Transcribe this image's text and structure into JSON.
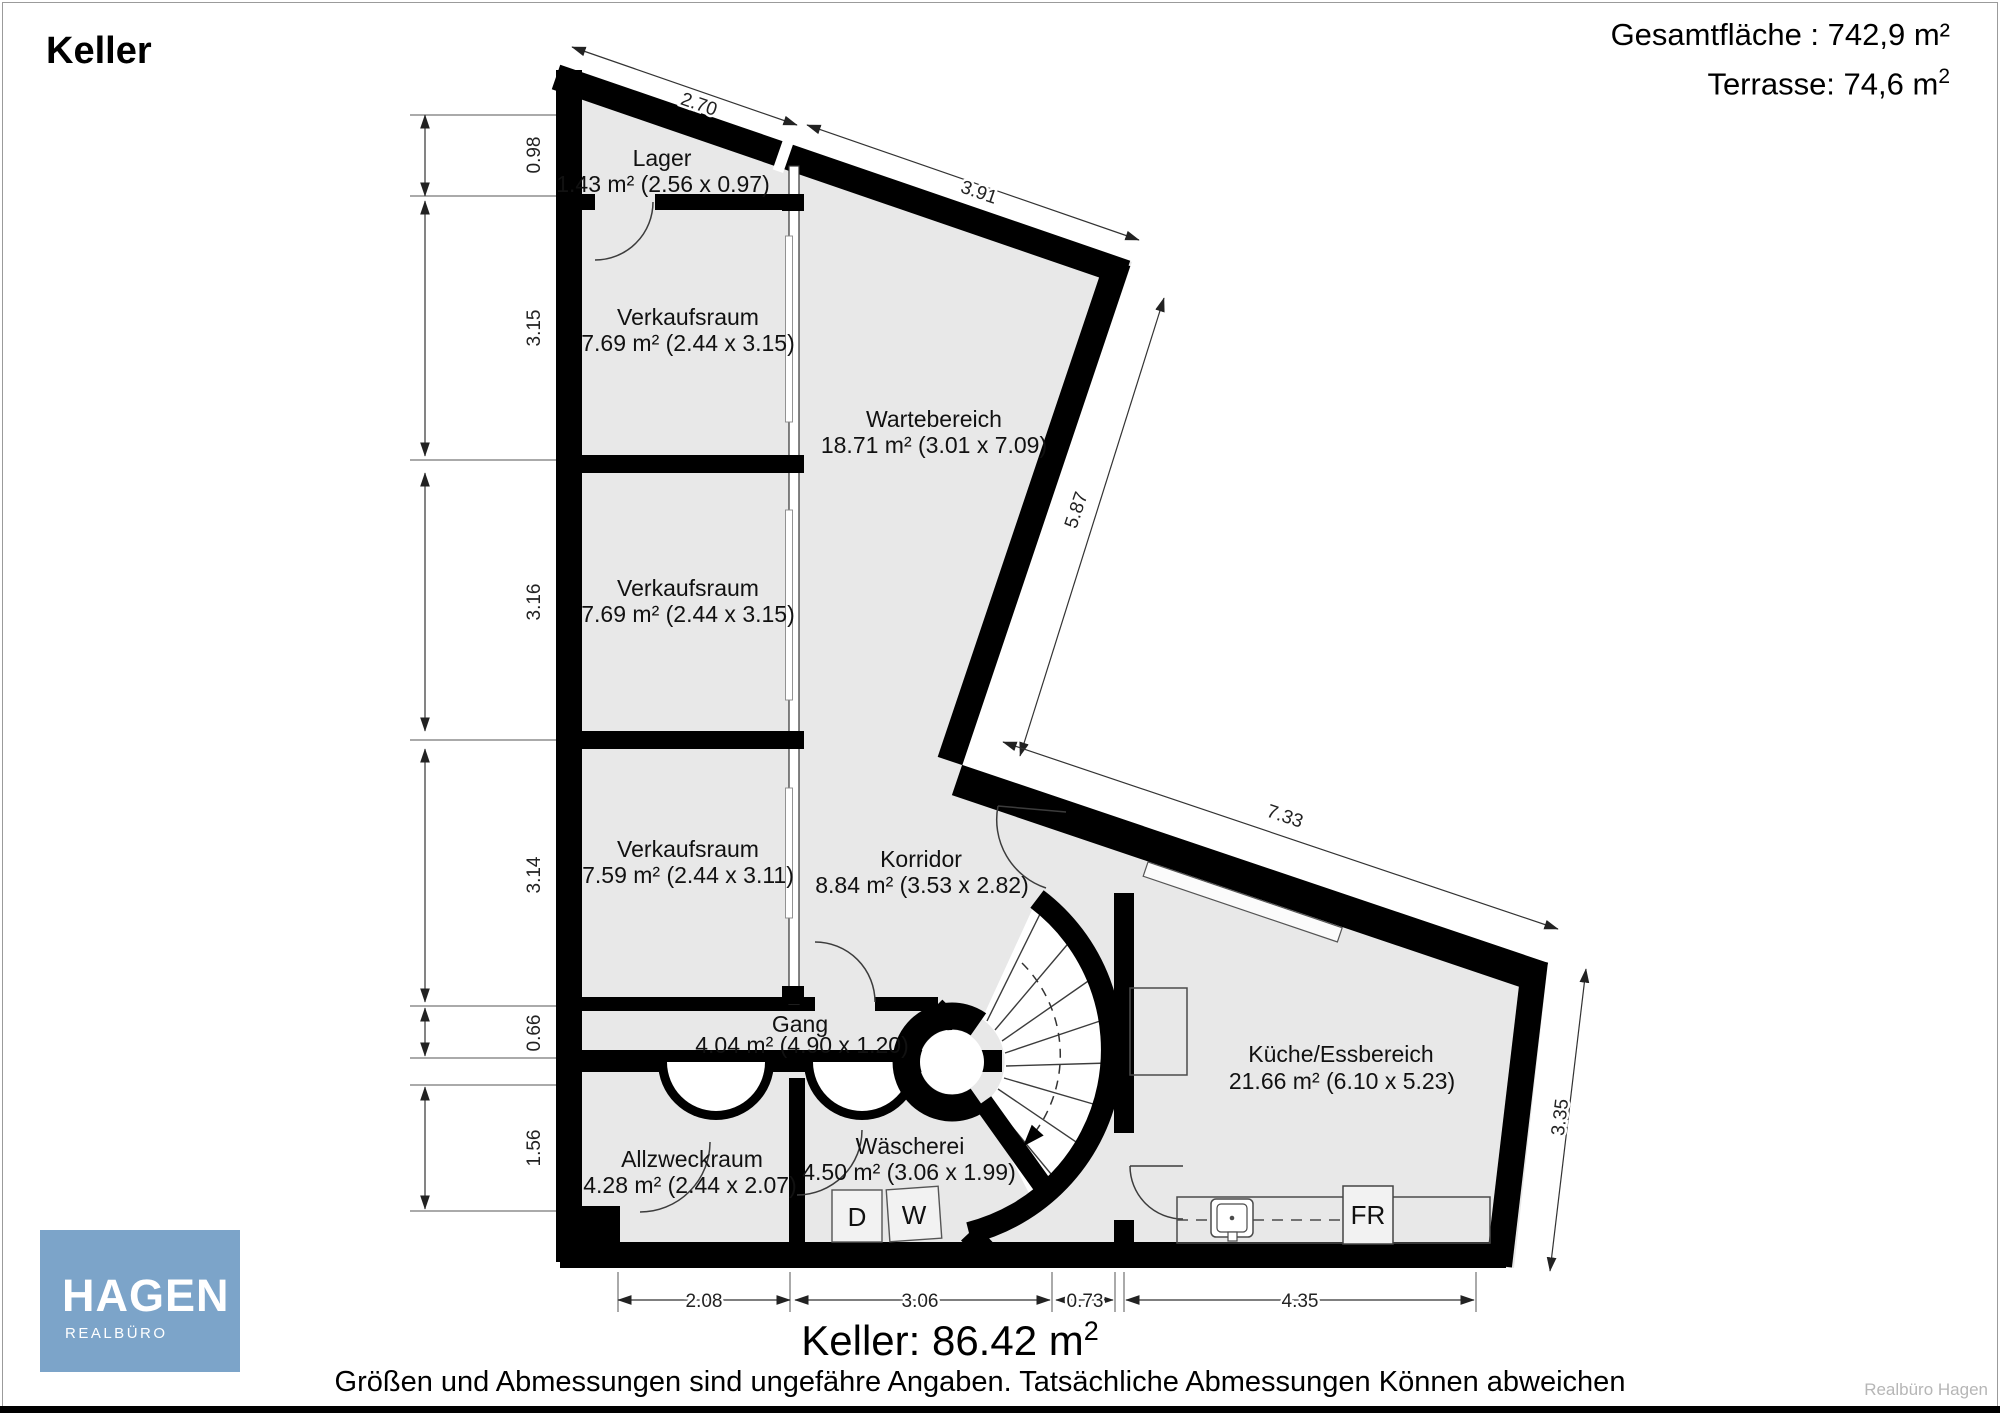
{
  "page": {
    "title": "Keller",
    "summary": {
      "total_area": "Gesamtfläche : 742,9  m²",
      "terrace_base": "Terrasse: 74,6 m",
      "terrace_sup": "2"
    },
    "footer": {
      "area_base": "Keller: 86.42 m",
      "area_sup": "2",
      "disclaimer": "Größen und Abmessungen sind ungefähre Angaben. Tatsächliche Abmessungen Können abweichen",
      "watermark": "Realbüro Hagen"
    },
    "logo": {
      "brand": "HAGEN",
      "subtitle": "REALBÜRO"
    }
  },
  "floorplan": {
    "rooms": [
      {
        "name": "Lager",
        "details": "1.43 m² (2.56 x 0.97)"
      },
      {
        "name": "Verkaufsraum",
        "details": "7.69 m² (2.44 x 3.15)"
      },
      {
        "name": "Verkaufsraum",
        "details": "7.69 m² (2.44 x 3.15)"
      },
      {
        "name": "Verkaufsraum",
        "details": "7.59 m² (2.44 x 3.11)"
      },
      {
        "name": "Wartebereich",
        "details": "18.71 m² (3.01 x 7.09)"
      },
      {
        "name": "Korridor",
        "details": "8.84 m² (3.53 x 2.82)"
      },
      {
        "name": "Gang",
        "details": "4.04 m² (4.90 x 1.20)"
      },
      {
        "name": "Allzweckraum",
        "details": "4.28 m² (2.44 x 2.07)"
      },
      {
        "name": "Wäscherei",
        "details": "4.50 m² (3.06 x 1.99)"
      },
      {
        "name": "Küche/Essbereich",
        "details": "21.66 m² (6.10 x 5.23)"
      }
    ],
    "appliances": {
      "dryer": "D",
      "washer": "W",
      "fridge": "FR"
    },
    "dimensions": {
      "left": [
        "0.98",
        "3.15",
        "3.16",
        "3.14",
        "0.66",
        "1.56"
      ],
      "top": [
        "2.70",
        "3.91"
      ],
      "right_upper": "5.87",
      "kitchen_top": "7.33",
      "right_lower": "3.35",
      "bottom": [
        "2.08",
        "3.06",
        "0.73",
        "4.35"
      ]
    },
    "colors": {
      "floor": "#e8e8e8",
      "wall": "#000000",
      "logo_bg": "#7ca4c9"
    }
  }
}
